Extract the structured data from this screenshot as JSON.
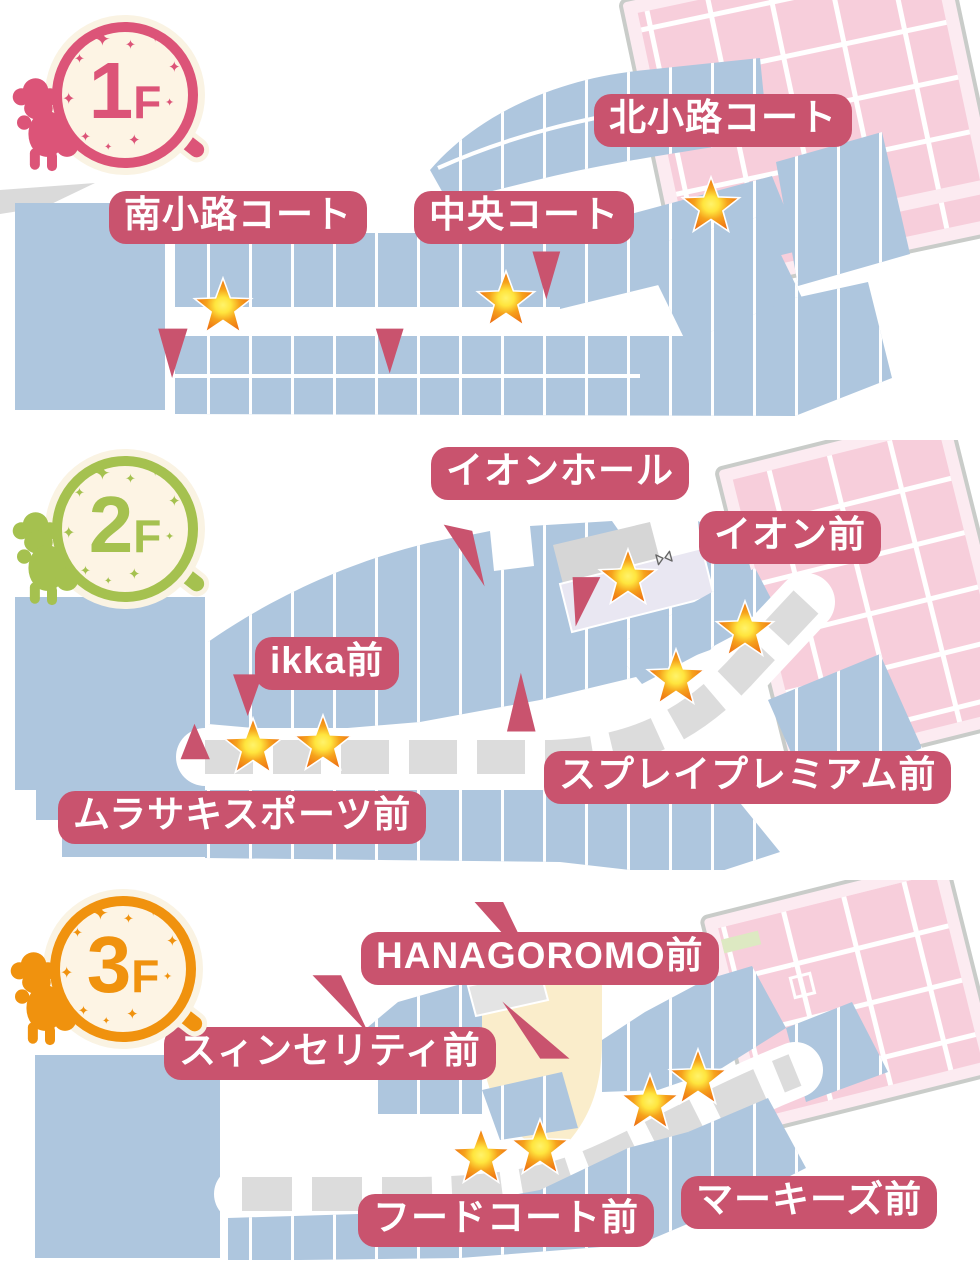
{
  "page": {
    "kind": "shopping-mall-floor-guide"
  },
  "colors": {
    "callout_bg": "#c9536e",
    "callout_text": "#ffffff",
    "map_block_blue": "#aec6de",
    "map_block_pink": "#f7cedb",
    "map_bg_pink": "#fcebf1",
    "map_outline_gray": "#c9ccc9",
    "walkway_dash_gray": "#dcdcdc",
    "star_orange": "#ee7314",
    "star_yellow": "#ffe53e",
    "badge_bg_cream": "#faf3e3",
    "food_court_cream": "#faedcb",
    "hall_lavender": "#e9e7f2",
    "green_block": "#dde9c2",
    "floor1_accent": "#dc5478",
    "floor2_accent": "#a5c14f",
    "floor3_accent": "#f0920e"
  },
  "floors": [
    {
      "badge_number": "1",
      "badge_suffix": "F",
      "badge_color": "#dc5478",
      "markers": [
        {
          "label": "北小路コート"
        },
        {
          "label": "南小路コート"
        },
        {
          "label": "中央コート"
        }
      ]
    },
    {
      "badge_number": "2",
      "badge_suffix": "F",
      "badge_color": "#a5c14f",
      "markers": [
        {
          "label": "イオンホール"
        },
        {
          "label": "イオン前"
        },
        {
          "label": "ikka前"
        },
        {
          "label": "ムラサキスポーツ前"
        },
        {
          "label": "スプレイプレミアム前"
        }
      ]
    },
    {
      "badge_number": "3",
      "badge_suffix": "F",
      "badge_color": "#f0920e",
      "markers": [
        {
          "label": "HANAGOROMO前"
        },
        {
          "label": "スィンセリティ前"
        },
        {
          "label": "フードコート前"
        },
        {
          "label": "マーキーズ前"
        }
      ]
    }
  ]
}
